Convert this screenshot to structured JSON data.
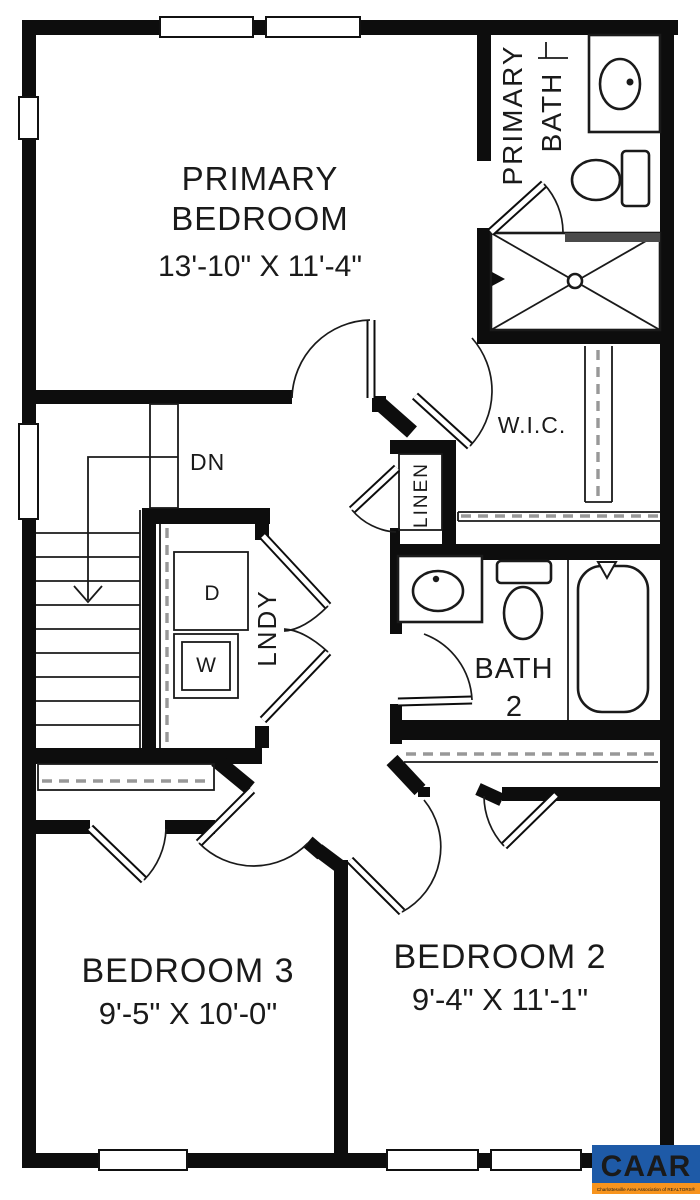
{
  "plan": {
    "rooms": {
      "primary_bedroom": {
        "line1": "PRIMARY",
        "line2": "BEDROOM",
        "dims": "13'-10\" X 11'-4\""
      },
      "primary_bath": {
        "line1": "PRIMARY",
        "line2": "BATH"
      },
      "wic": {
        "label": "W.I.C."
      },
      "linen": {
        "label": "LINEN"
      },
      "laundry": {
        "label": "LNDY",
        "dryer": "D",
        "washer": "W"
      },
      "bath2": {
        "line1": "BATH",
        "line2": "2"
      },
      "stairs": {
        "label": "DN"
      },
      "bedroom3": {
        "name": "BEDROOM 3",
        "dims": "9'-5\" X 10'-0\""
      },
      "bedroom2": {
        "name": "BEDROOM 2",
        "dims": "9'-4\" X 11'-1\""
      }
    }
  },
  "logo": {
    "name": "CAAR",
    "tagline": "Charlottesville Area Association of REALTORS®",
    "blue": "#1e5aa7",
    "orange": "#f7941e"
  }
}
